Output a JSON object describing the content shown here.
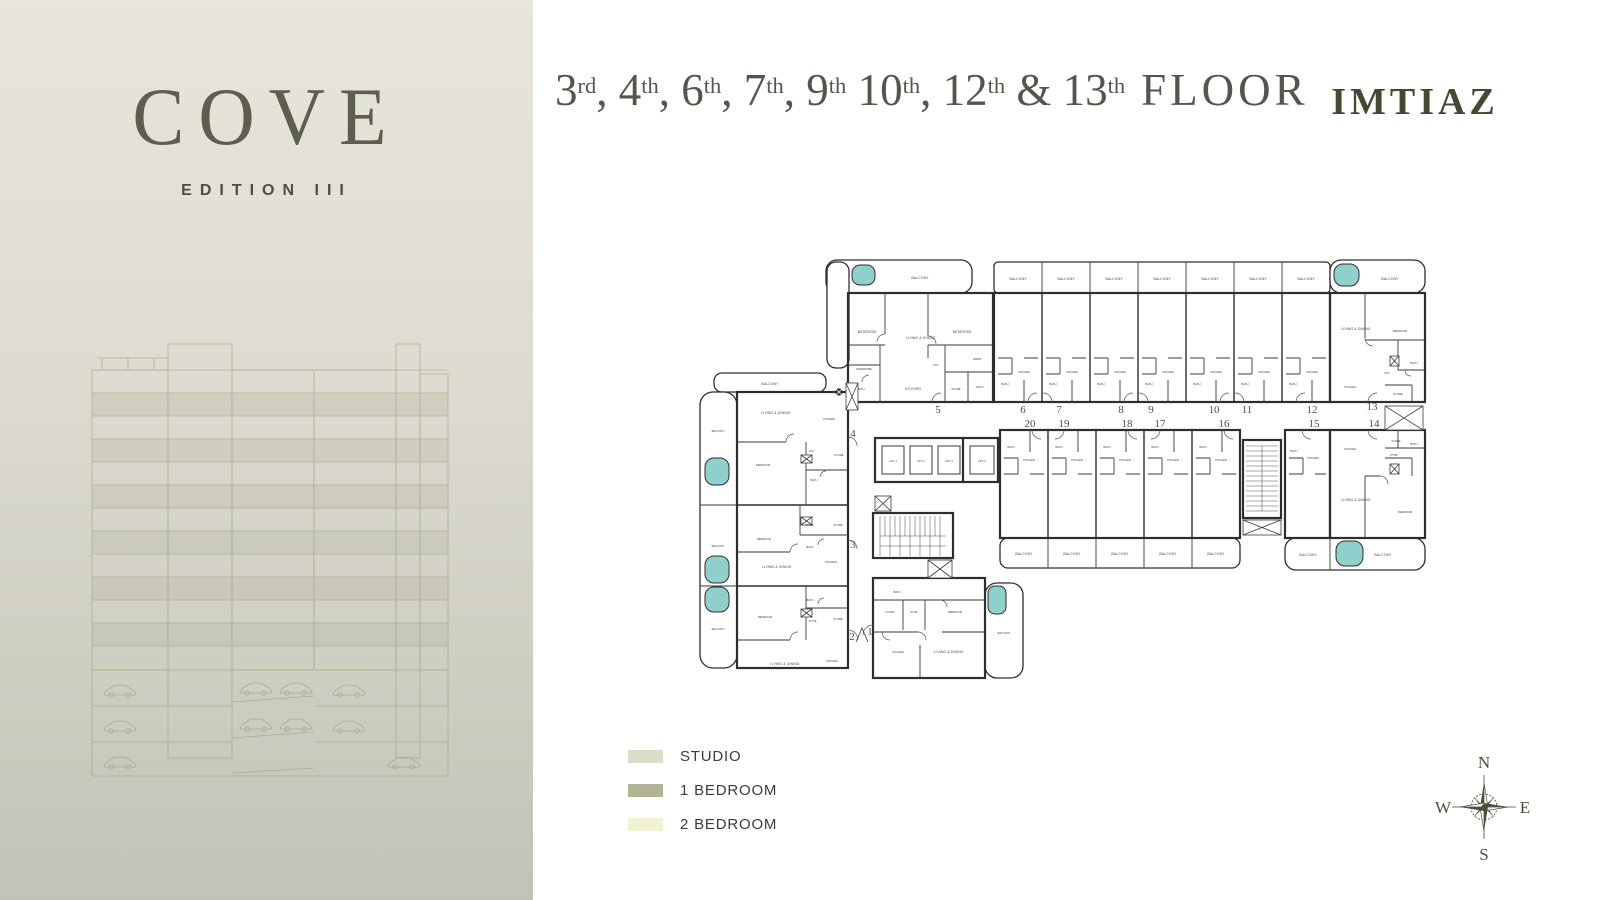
{
  "brand": {
    "name": "COVE",
    "edition": "EDITION III"
  },
  "header": {
    "floors": [
      {
        "num": "3",
        "sup": "rd",
        "sep": ", "
      },
      {
        "num": "4",
        "sup": "th",
        "sep": ", "
      },
      {
        "num": "6",
        "sup": "th",
        "sep": ", "
      },
      {
        "num": "7",
        "sup": "th",
        "sep": ", "
      },
      {
        "num": "9",
        "sup": "th",
        "sep": " "
      },
      {
        "num": "10",
        "sup": "th",
        "sep": ", "
      },
      {
        "num": "12",
        "sup": "th",
        "sep": " & "
      },
      {
        "num": "13",
        "sup": "th",
        "sep": ""
      }
    ],
    "floor_suffix": "FLOOR",
    "developer": "IMTIAZ"
  },
  "plan": {
    "room_labels": {
      "balcony": "BALCONY",
      "bedroom": "BEDROOM",
      "living": "LIVING & DINING",
      "kitchen": "KITCHEN",
      "bath": "BATH",
      "wardrobe": "WARDROBE",
      "store": "STORE",
      "ward": "WARD",
      "foy": "FOY",
      "ptoil": "P.TOIL",
      "laund": "LAUND",
      "lift1": "LIFT 1",
      "lift2": "LIFT 2",
      "lift3": "LIFT 3",
      "lift4": "LIFT 4"
    },
    "unit_numbers": {
      "u1": "1",
      "u2": "2",
      "u3": "3",
      "u4": "4",
      "u5": "5",
      "u6": "6",
      "u7": "7",
      "u8": "8",
      "u9": "9",
      "u10": "10",
      "u11": "11",
      "u12": "12",
      "u13": "13",
      "u14": "14",
      "u15": "15",
      "u16": "16",
      "u17": "17",
      "u18": "18",
      "u19": "19",
      "u20": "20"
    },
    "colors": {
      "studio": "#dcddc6",
      "one_bedroom": "#b3b495",
      "two_bedroom": "#f1f1d3",
      "tub": "#8fd0cd",
      "wall": "#2e2e2c"
    }
  },
  "legend": {
    "items": [
      {
        "label": "STUDIO",
        "color": "#dcddc6"
      },
      {
        "label": "1 BEDROOM",
        "color": "#b3b495"
      },
      {
        "label": "2 BEDROOM",
        "color": "#f1f1d3"
      }
    ]
  },
  "compass": {
    "north": "N",
    "east": "E",
    "south": "S",
    "west": "W"
  }
}
